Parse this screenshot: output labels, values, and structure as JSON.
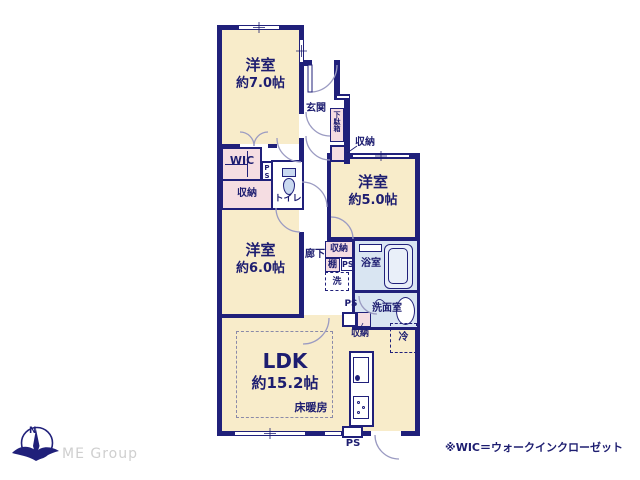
{
  "plan": {
    "rooms": {
      "room7": {
        "name": "洋室",
        "size": "約7.0帖"
      },
      "room5": {
        "name": "洋室",
        "size": "約5.0帖"
      },
      "room6": {
        "name": "洋室",
        "size": "約6.0帖"
      },
      "ldk": {
        "name": "LDK",
        "size": "約15.2帖"
      },
      "genkan": "玄関",
      "getabako": "下駄箱",
      "wic": "WIC",
      "toilet": "トイレ",
      "rouka": "廊下",
      "bath": "浴室",
      "senmen": "洗面室",
      "yukadanbo": "床暖房"
    },
    "storage": {
      "shuno_genkan": "収納",
      "shuno_wic": "収納",
      "shuno_hall": "収納",
      "shuno_senmen": "収納",
      "tana": "棚",
      "sen": "洗",
      "rei": "冷"
    },
    "ps": {
      "ps1": "PS",
      "ps2": "PS",
      "ps3": "PS",
      "ps4": "PS"
    }
  },
  "footer": {
    "logo_text": "ME Group",
    "compass_north": "N",
    "note": "※WIC＝ウォークインクローゼット"
  },
  "colors": {
    "wall": "#20207a",
    "floor": "#f8ecca",
    "closet": "#f5dde2",
    "wet_area": "#d9e5f2",
    "text": "#1d1d70",
    "door_arc": "#9b9bc2",
    "logo_gray": "#cfcfcf"
  }
}
